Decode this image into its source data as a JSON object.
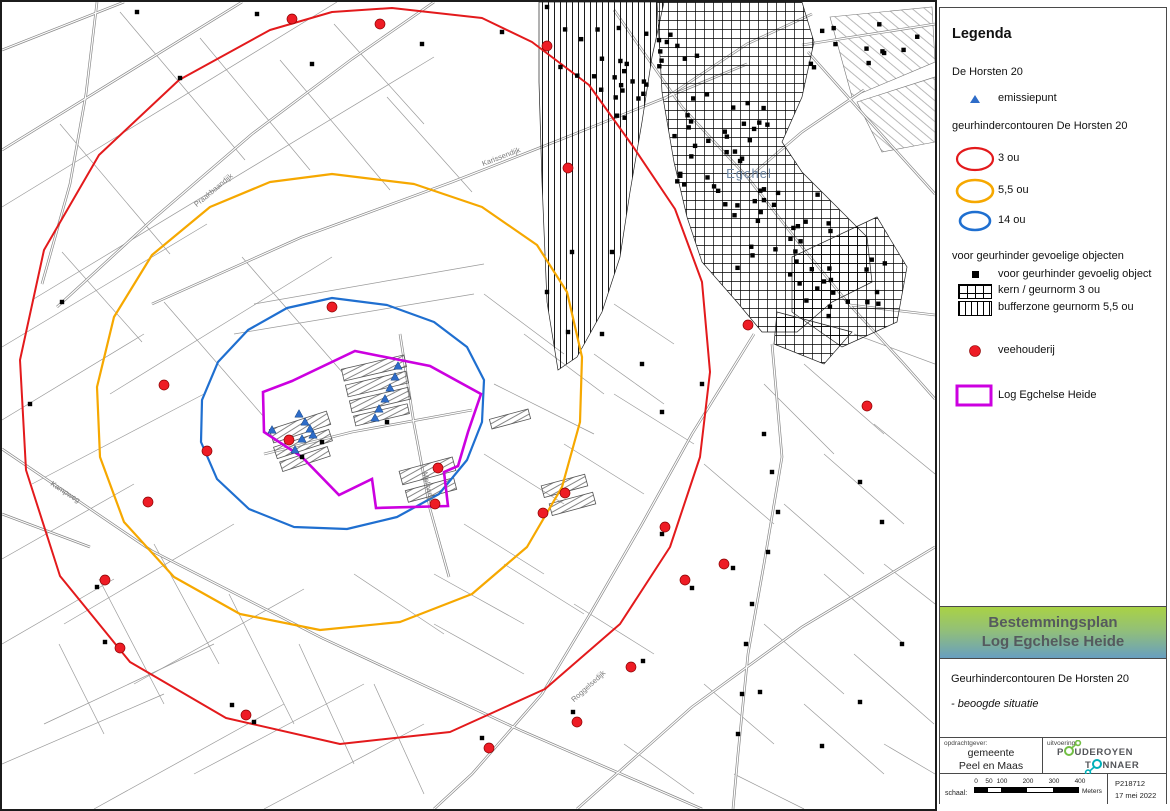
{
  "legend": {
    "title": "Legenda",
    "group1_label": "De Horsten 20",
    "emission_label": "emissiepunt",
    "emission_color": "#2e6cc8",
    "contours_label": "geurhindercontouren De Horsten 20",
    "contours": [
      {
        "label": "3 ou",
        "color": "#e31a1c"
      },
      {
        "label": "5,5 ou",
        "color": "#f6a800"
      },
      {
        "label": "14 ou",
        "color": "#1f6fd0"
      }
    ],
    "objects_label": "voor geurhinder gevoelige objecten",
    "object_item_label": "voor geurhinder gevoelig object",
    "kern_label": "kern / geurnorm 3 ou",
    "bufferzone_label": "bufferzone geurnorm 5,5 ou",
    "veehouderij_label": "veehouderij",
    "veehouderij_color": "#ee1c25",
    "log_label": "Log Egchelse Heide",
    "log_color": "#cc00e0"
  },
  "title_block": {
    "line1": "Bestemmingsplan",
    "line2": "Log Egchelse Heide",
    "subtitle": "Geurhindercontouren De Horsten 20",
    "subtitle2": "- beoogde situatie"
  },
  "footer": {
    "client_label": "opdrachtgever:",
    "client_line1": "gemeente",
    "client_line2": "Peel en Maas",
    "executor_label": "uitvoering:",
    "logo_p1": "P",
    "logo_p2": "UDEROYEN",
    "logo_p3": "T",
    "logo_p4": "NNAER",
    "scale_label": "schaal:",
    "scale_ticks": [
      "0",
      "50",
      "100",
      "200",
      "300",
      "400"
    ],
    "scale_unit": "Meters",
    "project_number": "P218712",
    "date": "17 mei 2022"
  },
  "map": {
    "town_label": "Egchel",
    "town_label_color": "#6f88a5",
    "street_labels": [
      {
        "text": "Karissendijk",
        "x": 500,
        "y": 157,
        "angle": -21
      },
      {
        "text": "Praakbaandijk",
        "x": 213,
        "y": 190,
        "angle": -40
      },
      {
        "text": "Melkweg",
        "x": 424,
        "y": 485,
        "angle": 76
      },
      {
        "text": "Kampweg",
        "x": 62,
        "y": 492,
        "angle": 33
      },
      {
        "text": "Roggelsedijk",
        "x": 588,
        "y": 686,
        "angle": -42
      }
    ],
    "veehouderij_points": [
      [
        290,
        17
      ],
      [
        378,
        22
      ],
      [
        545,
        44
      ],
      [
        566,
        166
      ],
      [
        746,
        323
      ],
      [
        865,
        404
      ],
      [
        330,
        305
      ],
      [
        162,
        383
      ],
      [
        205,
        449
      ],
      [
        287,
        438
      ],
      [
        436,
        466
      ],
      [
        433,
        502
      ],
      [
        541,
        511
      ],
      [
        563,
        491
      ],
      [
        146,
        500
      ],
      [
        103,
        578
      ],
      [
        118,
        646
      ],
      [
        244,
        713
      ],
      [
        487,
        746
      ],
      [
        575,
        720
      ],
      [
        629,
        665
      ],
      [
        663,
        525
      ],
      [
        683,
        578
      ],
      [
        722,
        562
      ]
    ],
    "emission_points": [
      [
        270,
        428
      ],
      [
        297,
        412
      ],
      [
        303,
        420
      ],
      [
        308,
        427
      ],
      [
        300,
        437
      ],
      [
        293,
        448
      ],
      [
        311,
        433
      ],
      [
        393,
        375
      ],
      [
        388,
        386
      ],
      [
        383,
        397
      ],
      [
        377,
        407
      ],
      [
        373,
        416
      ],
      [
        396,
        364
      ]
    ],
    "object_squares": [
      [
        255,
        12
      ],
      [
        310,
        62
      ],
      [
        178,
        76
      ],
      [
        103,
        640
      ],
      [
        95,
        585
      ],
      [
        230,
        703
      ],
      [
        252,
        720
      ],
      [
        480,
        736
      ],
      [
        571,
        710
      ],
      [
        641,
        659
      ],
      [
        660,
        532
      ],
      [
        690,
        586
      ],
      [
        731,
        566
      ],
      [
        758,
        690
      ],
      [
        820,
        744
      ],
      [
        858,
        700
      ],
      [
        900,
        642
      ],
      [
        762,
        432
      ],
      [
        770,
        470
      ],
      [
        776,
        510
      ],
      [
        766,
        550
      ],
      [
        750,
        602
      ],
      [
        744,
        642
      ],
      [
        740,
        692
      ],
      [
        736,
        732
      ],
      [
        858,
        480
      ],
      [
        880,
        520
      ],
      [
        640,
        362
      ],
      [
        600,
        332
      ],
      [
        566,
        330
      ],
      [
        660,
        410
      ],
      [
        700,
        382
      ],
      [
        300,
        455
      ],
      [
        320,
        440
      ],
      [
        385,
        420
      ],
      [
        545,
        5
      ],
      [
        500,
        30
      ],
      [
        420,
        42
      ],
      [
        135,
        10
      ],
      [
        60,
        300
      ],
      [
        28,
        402
      ],
      [
        570,
        250
      ],
      [
        610,
        250
      ],
      [
        545,
        290
      ]
    ],
    "object_clusters": [
      {
        "cx": 660,
        "cy": 72,
        "rx": 52,
        "ry": 46,
        "count": 26,
        "seed": 7
      },
      {
        "cx": 722,
        "cy": 152,
        "rx": 52,
        "ry": 52,
        "count": 30,
        "seed": 13
      },
      {
        "cx": 782,
        "cy": 235,
        "rx": 50,
        "ry": 48,
        "count": 26,
        "seed": 29
      },
      {
        "cx": 842,
        "cy": 286,
        "rx": 42,
        "ry": 32,
        "count": 14,
        "seed": 41
      },
      {
        "cx": 866,
        "cy": 46,
        "rx": 62,
        "ry": 24,
        "count": 12,
        "seed": 53
      },
      {
        "cx": 596,
        "cy": 62,
        "rx": 40,
        "ry": 38,
        "count": 10,
        "seed": 67
      }
    ]
  }
}
